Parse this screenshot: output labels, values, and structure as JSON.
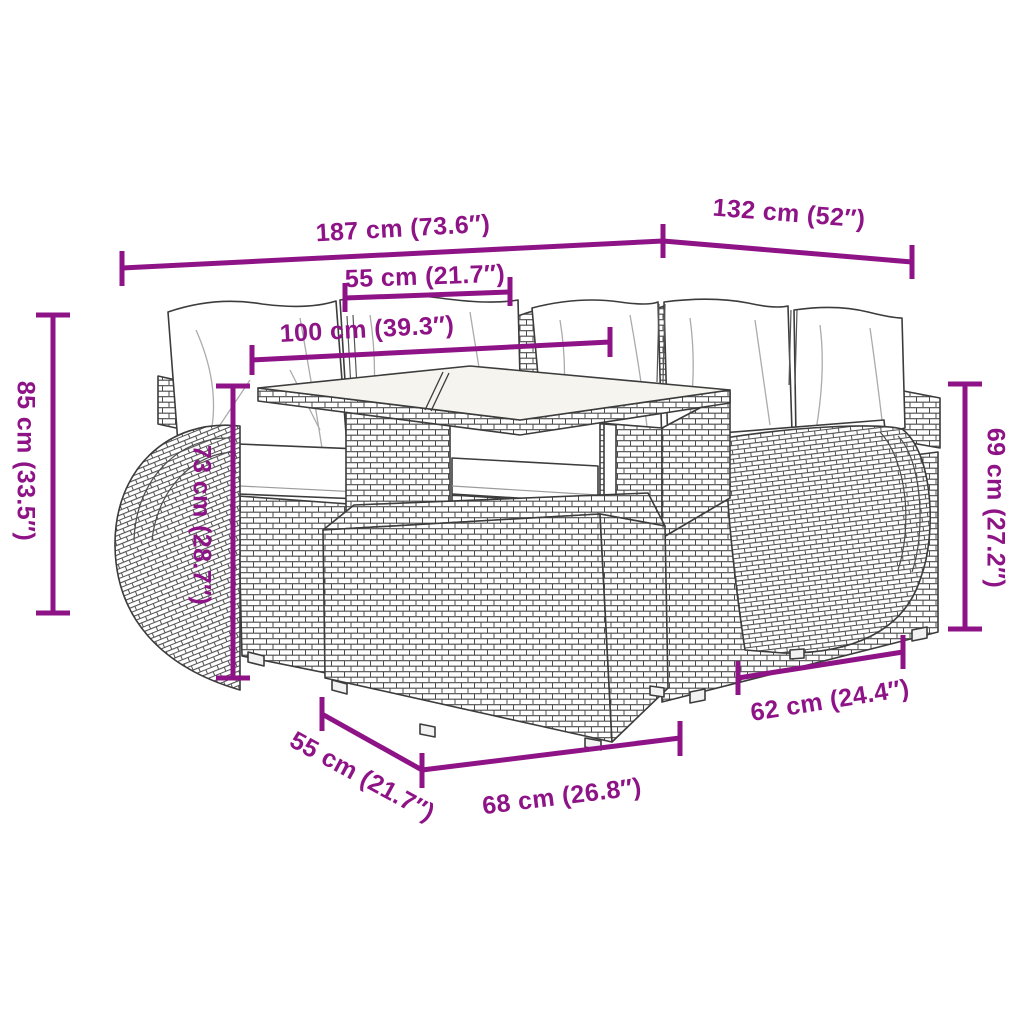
{
  "accent_color": "#8E1386",
  "art": {
    "outline_color": "#3c3c3c",
    "weave_color": "#4c4c4c",
    "cushion_color": "#ffffff",
    "glass_color": "#f5f4ef"
  },
  "dimensions": {
    "total_width": "187 cm (73.6″)",
    "right_section_width": "132 cm (52″)",
    "table_top_width": "55 cm (21.7″)",
    "sofa_back_width": "100 cm (39.3″)",
    "overall_height": "85 cm (33.5″)",
    "table_height": "73 cm (28.7″)",
    "armrest_height": "69 cm (27.2″)",
    "footstool_depth": "62 cm (24.4″)",
    "footstool_side_depth": "55 cm (21.7″)",
    "footstool_width": "68 cm (26.8″)"
  }
}
